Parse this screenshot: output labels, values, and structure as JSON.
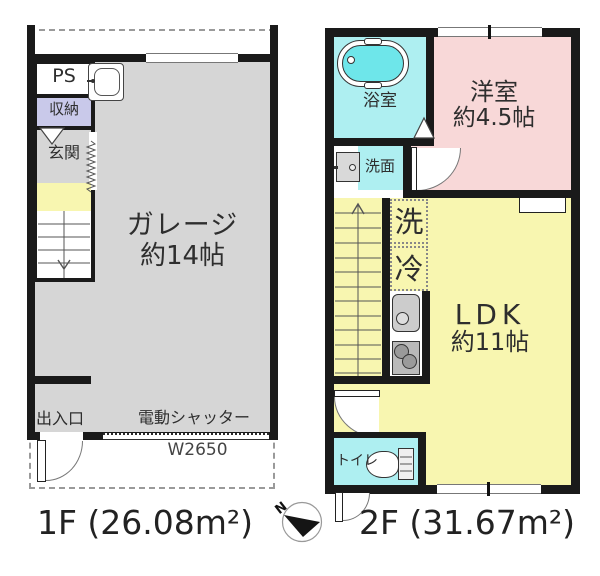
{
  "title": "floor-plan",
  "floor1": {
    "area_label": "1F (26.08m²)",
    "rooms": {
      "ps": "PS",
      "storage": "収納",
      "entrance_hall": "玄関",
      "garage_line1": "ガレージ",
      "garage_line2": "約14帖",
      "doorway": "出入口",
      "shutter": "電動シャッター",
      "shutter_width": "W2650"
    }
  },
  "floor2": {
    "area_label": "2F (31.67m²)",
    "rooms": {
      "bathroom": "浴室",
      "western_room_line1": "洋室",
      "western_room_line2": "約4.5帖",
      "washroom": "洗面",
      "washer": "洗",
      "fridge": "冷",
      "ldk_line1": "LDK",
      "ldk_line2": "約11帖",
      "toilet": "トイレ"
    }
  },
  "compass": {
    "north_label": "N"
  },
  "colors": {
    "wall": "#1a1a1a",
    "garage_gray": "#d6d6d6",
    "storage_lavender": "#c9c9ea",
    "yellow": "#f8f6b0",
    "bedroom_pink": "#f8d8d8",
    "wet_area_cyan": "#aeeff1",
    "bathtub_cyan": "#6ee6ea"
  }
}
